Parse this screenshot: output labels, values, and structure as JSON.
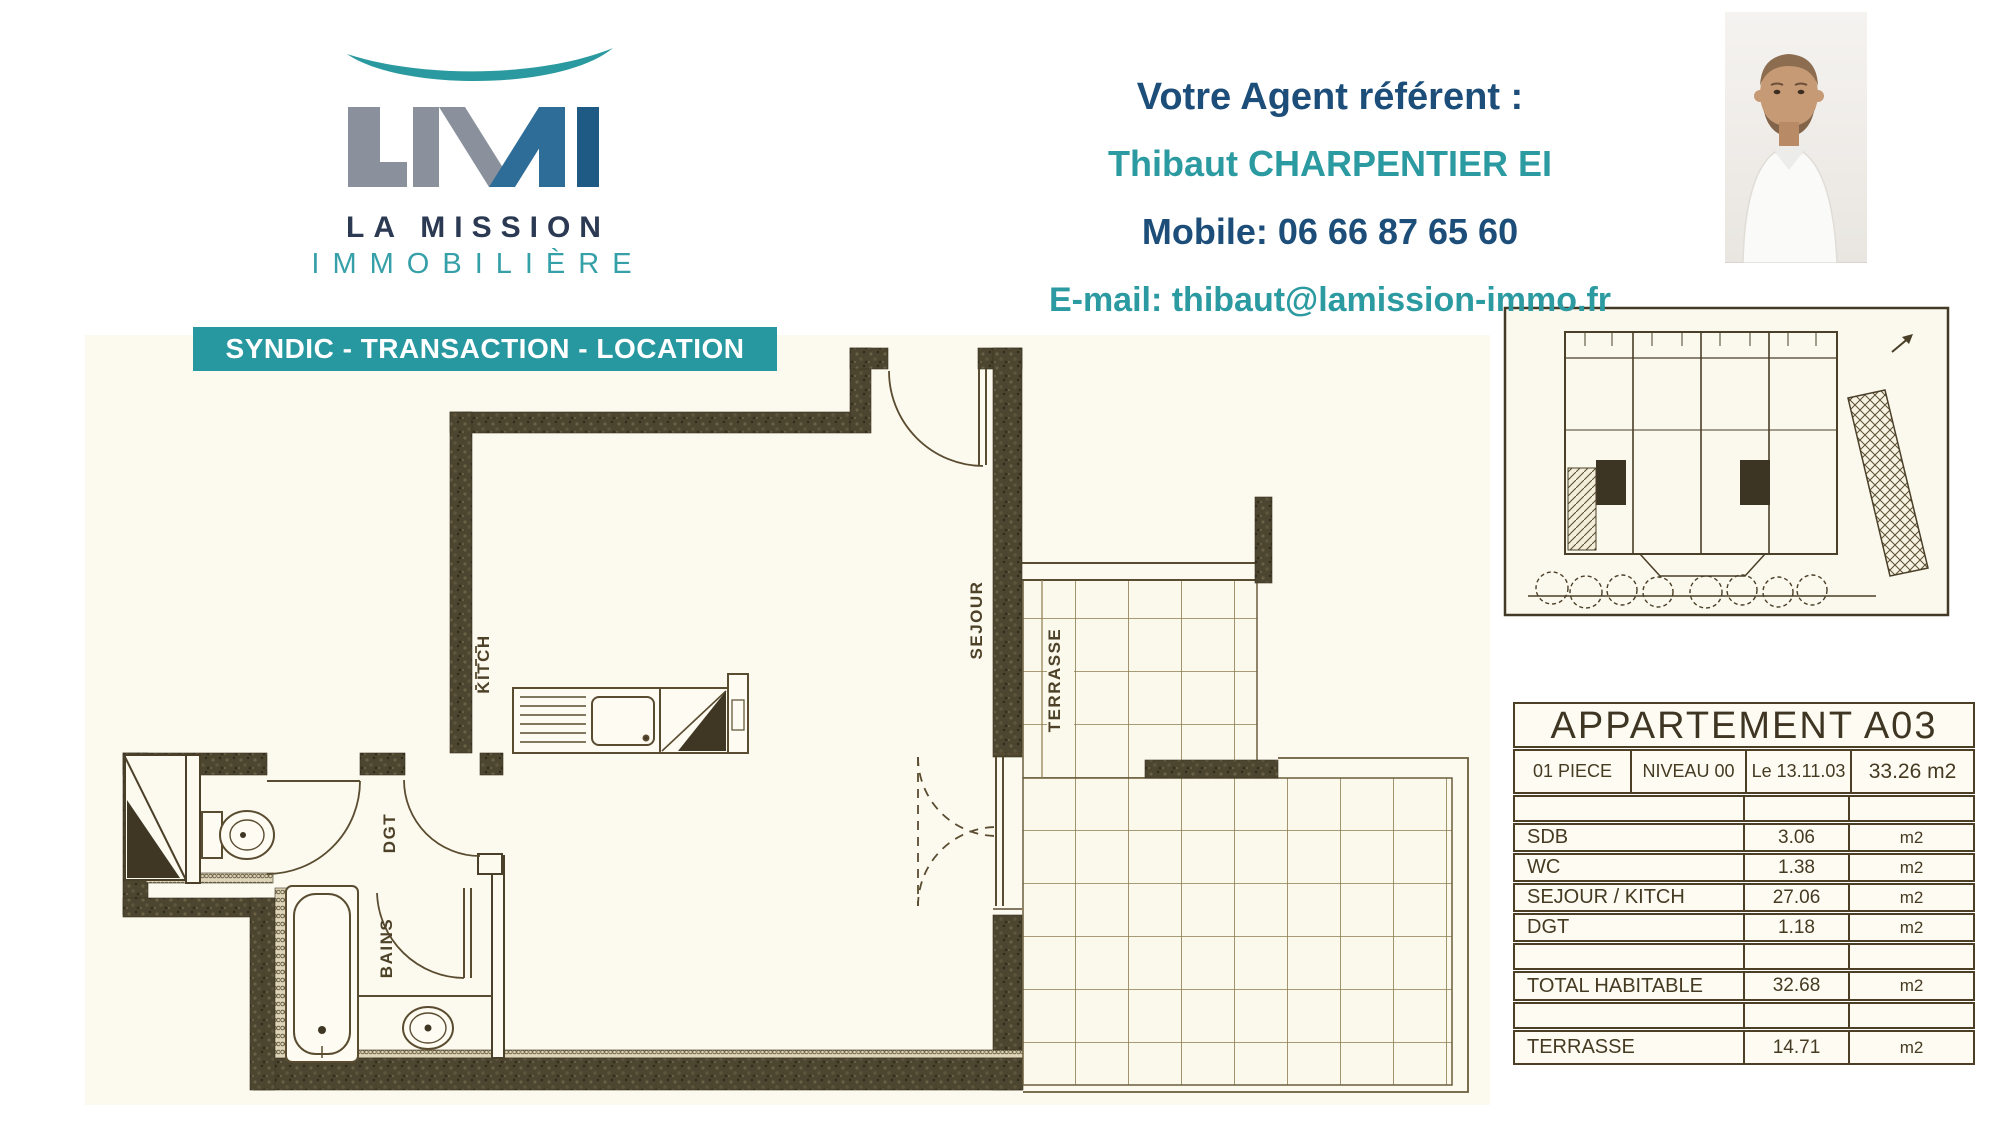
{
  "brand": {
    "monogram": "LMI",
    "name_line1": "LA MISSION",
    "name_line2": "IMMOBILIÈRE",
    "banner": "SYNDIC - TRANSACTION - LOCATION",
    "colors": {
      "teal": "#2898a0",
      "navy": "#2b3a52",
      "logo_gray": "#8b919c",
      "logo_blue": "#2e6d97",
      "logo_dark_blue": "#1f5a84"
    }
  },
  "agent": {
    "intro": "Votre Agent référent :",
    "name": "Thibaut CHARPENTIER EI",
    "mobile": "Mobile: 06 66 87 65 60",
    "email": "E-mail: thibaut@lamission-immo.fr"
  },
  "floor_plan": {
    "ink": "#4a432d",
    "labels": {
      "kitchen": "KITCH",
      "living": "SEJOUR",
      "terrace": "TERRASSE",
      "hallway": "DGT",
      "bath": "BAINS"
    }
  },
  "summary_table": {
    "title": "APPARTEMENT A03",
    "header": [
      "01 PIECE",
      "NIVEAU 00",
      "Le 13.11.03",
      "33.26 m2"
    ],
    "rooms": [
      {
        "label": "SDB",
        "value": "3.06",
        "unit": "m2"
      },
      {
        "label": "WC",
        "value": "1.38",
        "unit": "m2"
      },
      {
        "label": "SEJOUR / KITCH",
        "value": "27.06",
        "unit": "m2"
      },
      {
        "label": "DGT",
        "value": "1.18",
        "unit": "m2"
      }
    ],
    "total": {
      "label": "TOTAL HABITABLE",
      "value": "32.68",
      "unit": "m2"
    },
    "terrace": {
      "label": "TERRASSE",
      "value": "14.71",
      "unit": "m2"
    }
  }
}
